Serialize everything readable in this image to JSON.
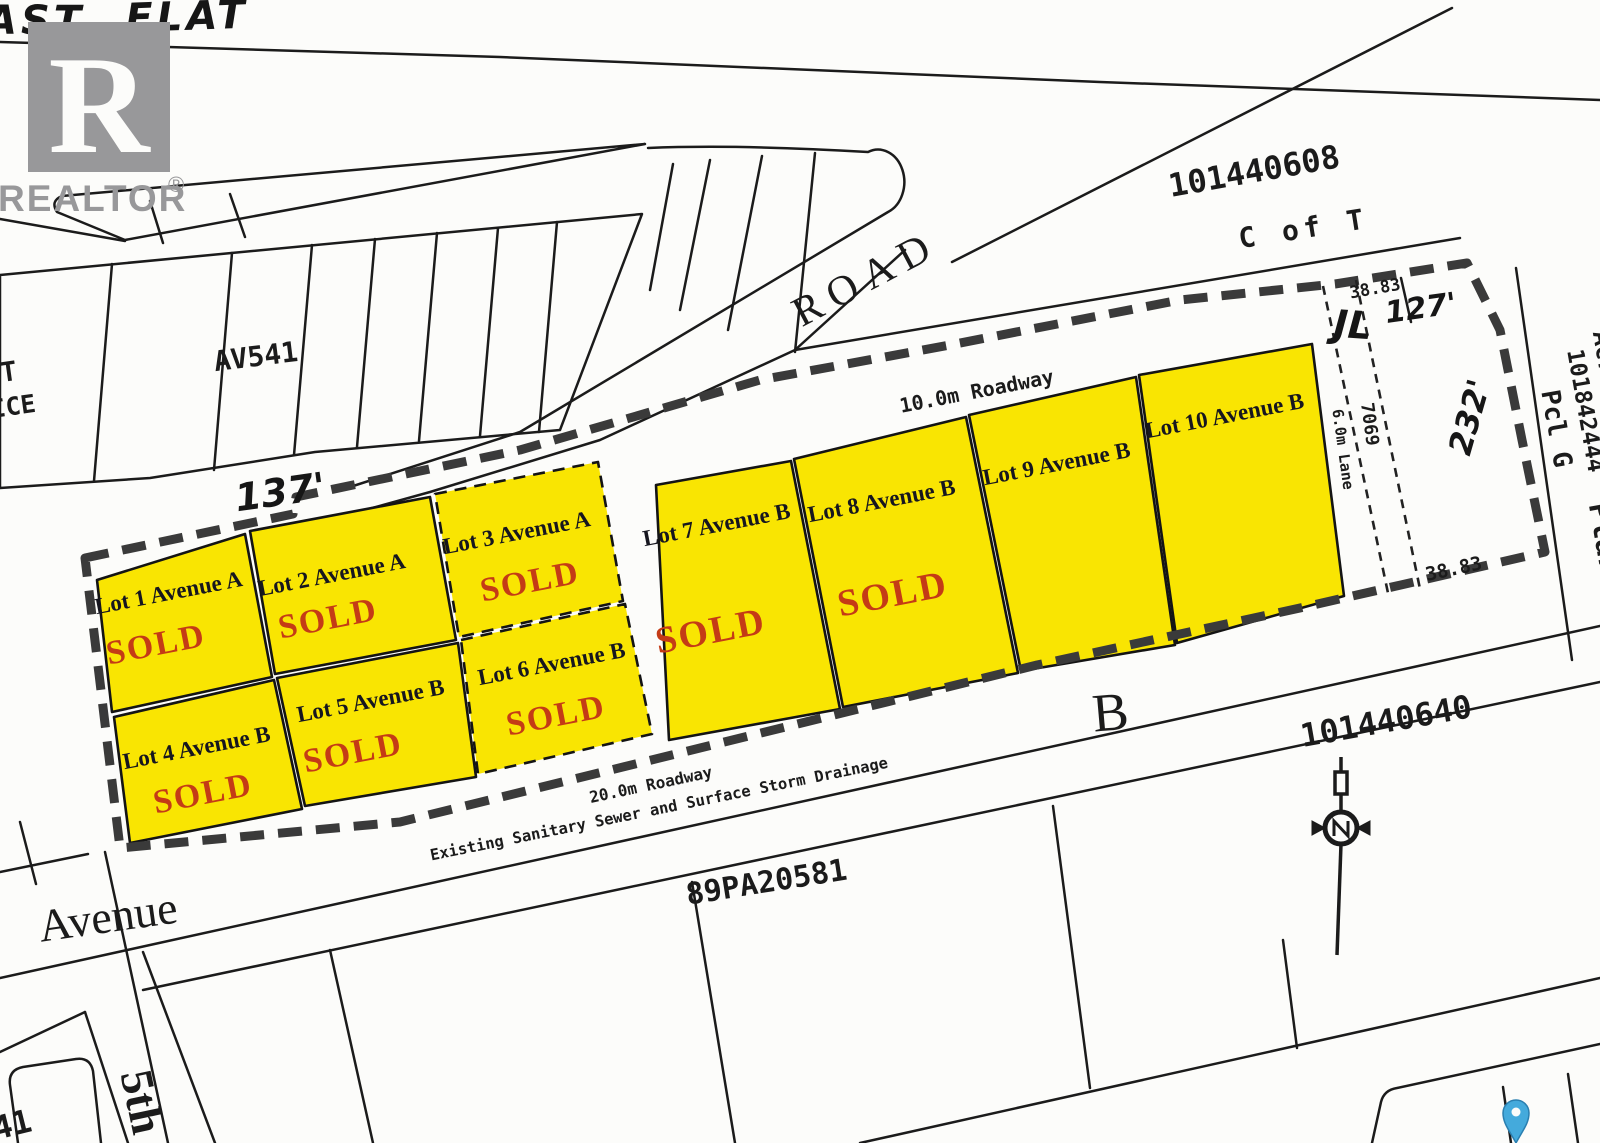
{
  "branding": {
    "logo_letter": "R",
    "wordmark": "REALTOR",
    "registered": "®"
  },
  "handwriting": {
    "top_word_1": "AST",
    "top_word_2": "FLAT",
    "dim_137": "137'",
    "dim_127": "127'",
    "dim_232": "232'",
    "initials": "JL"
  },
  "roads": {
    "road": "ROAD",
    "roadway_10m": "10.0m Roadway",
    "roadway_20m": "20.0m Roadway",
    "sewer_note": "Existing Sanitary Sewer and Surface Storm Drainage",
    "lane_6m": "6.0m Lane",
    "avenue": "Avenue",
    "street_5th": "5th"
  },
  "parcels": {
    "p101440608": "101440608",
    "c_of_t": "C of T",
    "p89pa20581": "89PA20581",
    "p101440640": "101440640",
    "pcl_g": "Pcl G",
    "pcl_g_number": "101842444",
    "plan_word": "Plan",
    "acres_word": "Acres",
    "av541": "AV541",
    "block_letter": "B",
    "partial_t": "T",
    "partial_ice": "ICE",
    "partial_41": "41"
  },
  "survey": {
    "dim_3883_top": "38.83",
    "dim_3883_bottom": "38.83",
    "dim_7069": "7069"
  },
  "lots": [
    {
      "id": "lot-1",
      "label": "Lot 1 Avenue A",
      "status": "SOLD"
    },
    {
      "id": "lot-2",
      "label": "Lot 2 Avenue A",
      "status": "SOLD"
    },
    {
      "id": "lot-3",
      "label": "Lot 3 Avenue A",
      "status": "SOLD"
    },
    {
      "id": "lot-4",
      "label": "Lot 4 Avenue B",
      "status": "SOLD"
    },
    {
      "id": "lot-5",
      "label": "Lot 5 Avenue B",
      "status": "SOLD"
    },
    {
      "id": "lot-6",
      "label": "Lot 6 Avenue B",
      "status": "SOLD"
    },
    {
      "id": "lot-7",
      "label": "Lot 7 Avenue B",
      "status": "SOLD"
    },
    {
      "id": "lot-8",
      "label": "Lot 8 Avenue B",
      "status": "SOLD"
    },
    {
      "id": "lot-9",
      "label": "Lot 9 Avenue B",
      "status": ""
    },
    {
      "id": "lot-10",
      "label": "Lot 10 Avenue B",
      "status": ""
    }
  ],
  "colors": {
    "lot_yellow": "#f9e502",
    "sold_red": "#c43b16",
    "ink_black": "#1b1b1b",
    "boundary_gray": "#3a3a3a",
    "logo_gray": "#98989a",
    "pin_blue": "#44aadc"
  }
}
